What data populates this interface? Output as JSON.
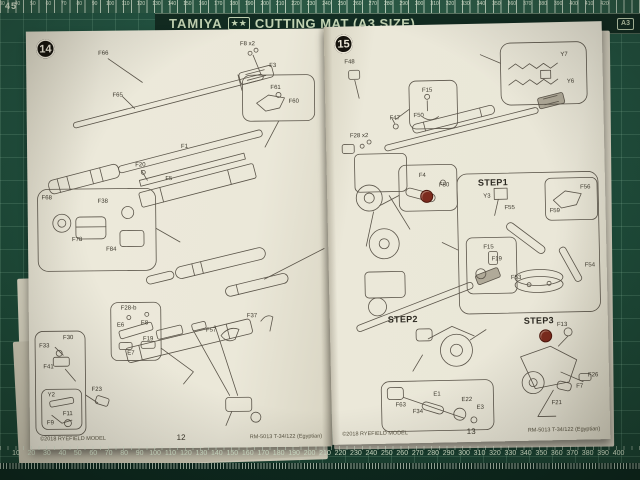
{
  "mat": {
    "brand": "TAMIYA",
    "stars": "★★",
    "product": "CUTTING MAT (A3 SIZE)",
    "badge": "A3",
    "corner_number": "45",
    "top_ruler": [
      "30",
      "40",
      "50",
      "60",
      "70",
      "80",
      "90",
      "100",
      "110",
      "120",
      "130",
      "140",
      "150",
      "160",
      "170",
      "180",
      "190",
      "200",
      "210",
      "220",
      "230",
      "240",
      "250",
      "260",
      "270",
      "280",
      "290",
      "300",
      "310",
      "320",
      "330",
      "340",
      "350",
      "360",
      "370",
      "380",
      "390",
      "400",
      "410",
      "420"
    ],
    "bottom_ruler": [
      "10",
      "20",
      "30",
      "40",
      "50",
      "60",
      "70",
      "80",
      "90",
      "100",
      "110",
      "120",
      "130",
      "140",
      "150",
      "160",
      "170",
      "180",
      "190",
      "200",
      "210",
      "220",
      "230",
      "240",
      "250",
      "260",
      "270",
      "280",
      "290",
      "300",
      "310",
      "320",
      "330",
      "340",
      "350",
      "360",
      "370",
      "380",
      "390",
      "400"
    ]
  },
  "left_page": {
    "step_number": "14",
    "page_number": "12",
    "footer_left": "©2018 RYEFIELD MODEL",
    "footer_right": "RM-5013 T-34/122 (Egyptian)",
    "labels": [
      {
        "text": "F66",
        "x": 72,
        "y": 20
      },
      {
        "text": "F65",
        "x": 86,
        "y": 62
      },
      {
        "text": "F8 x2",
        "x": 214,
        "y": 12
      },
      {
        "text": "F3",
        "x": 243,
        "y": 34
      },
      {
        "text": "F61",
        "x": 244,
        "y": 56
      },
      {
        "text": "F60",
        "x": 262,
        "y": 70
      },
      {
        "text": "F20",
        "x": 108,
        "y": 132
      },
      {
        "text": "F1",
        "x": 154,
        "y": 114
      },
      {
        "text": "F5",
        "x": 138,
        "y": 146
      },
      {
        "text": "F68",
        "x": 14,
        "y": 164
      },
      {
        "text": "F38",
        "x": 70,
        "y": 168
      },
      {
        "text": "F78",
        "x": 44,
        "y": 206
      },
      {
        "text": "F84",
        "x": 78,
        "y": 216
      },
      {
        "text": "F37",
        "x": 218,
        "y": 284
      },
      {
        "text": "F57",
        "x": 177,
        "y": 298
      },
      {
        "text": "F28-b",
        "x": 92,
        "y": 275
      },
      {
        "text": "E6",
        "x": 88,
        "y": 292
      },
      {
        "text": "E8",
        "x": 112,
        "y": 290
      },
      {
        "text": "F19",
        "x": 114,
        "y": 306
      },
      {
        "text": "E7",
        "x": 98,
        "y": 320
      },
      {
        "text": "F30",
        "x": 34,
        "y": 304
      },
      {
        "text": "F33",
        "x": 10,
        "y": 312
      },
      {
        "text": "F41",
        "x": 14,
        "y": 333
      },
      {
        "text": "Y2",
        "x": 18,
        "y": 361
      },
      {
        "text": "F23",
        "x": 62,
        "y": 356
      },
      {
        "text": "F11",
        "x": 33,
        "y": 380
      },
      {
        "text": "F9",
        "x": 17,
        "y": 389
      }
    ]
  },
  "right_page": {
    "step_number": "15",
    "page_number": "13",
    "footer_left": "©2018 RYEFIELD MODEL",
    "footer_right": "RM-5013 T-34/122 (Egyptian)",
    "steps": [
      {
        "text": "STEP1",
        "x": 151,
        "y": 154
      },
      {
        "text": "STEP2",
        "x": 58,
        "y": 289
      },
      {
        "text": "STEP3",
        "x": 194,
        "y": 293
      }
    ],
    "labels": [
      {
        "text": "F48",
        "x": 20,
        "y": 33
      },
      {
        "text": "F47",
        "x": 64,
        "y": 90
      },
      {
        "text": "F15",
        "x": 97,
        "y": 63
      },
      {
        "text": "F50",
        "x": 88,
        "y": 88
      },
      {
        "text": "Y7",
        "x": 236,
        "y": 30
      },
      {
        "text": "Y6",
        "x": 242,
        "y": 57
      },
      {
        "text": "F28 x2",
        "x": 24,
        "y": 107
      },
      {
        "text": "F4",
        "x": 92,
        "y": 148
      },
      {
        "text": "F50",
        "x": 112,
        "y": 158
      },
      {
        "text": "Y3",
        "x": 156,
        "y": 170
      },
      {
        "text": "F55",
        "x": 177,
        "y": 182
      },
      {
        "text": "F56",
        "x": 253,
        "y": 163
      },
      {
        "text": "F59",
        "x": 222,
        "y": 186
      },
      {
        "text": "F15",
        "x": 155,
        "y": 221
      },
      {
        "text": "F19",
        "x": 163,
        "y": 233
      },
      {
        "text": "F54",
        "x": 256,
        "y": 241
      },
      {
        "text": "F53",
        "x": 182,
        "y": 252
      },
      {
        "text": "F13",
        "x": 227,
        "y": 300
      },
      {
        "text": "F26",
        "x": 257,
        "y": 351
      },
      {
        "text": "F7",
        "x": 245,
        "y": 362
      },
      {
        "text": "F21",
        "x": 220,
        "y": 378
      },
      {
        "text": "F63",
        "x": 64,
        "y": 377
      },
      {
        "text": "F34",
        "x": 81,
        "y": 384
      },
      {
        "text": "E1",
        "x": 102,
        "y": 367
      },
      {
        "text": "E22",
        "x": 130,
        "y": 373
      },
      {
        "text": "E3",
        "x": 145,
        "y": 381
      }
    ]
  },
  "palette": {
    "mat_green": "#1e4c3a",
    "banner_green": "#122c22",
    "page_cream": "#ebe8d9",
    "ink": "#3c382d",
    "red_marker": "#7c2b1e"
  }
}
